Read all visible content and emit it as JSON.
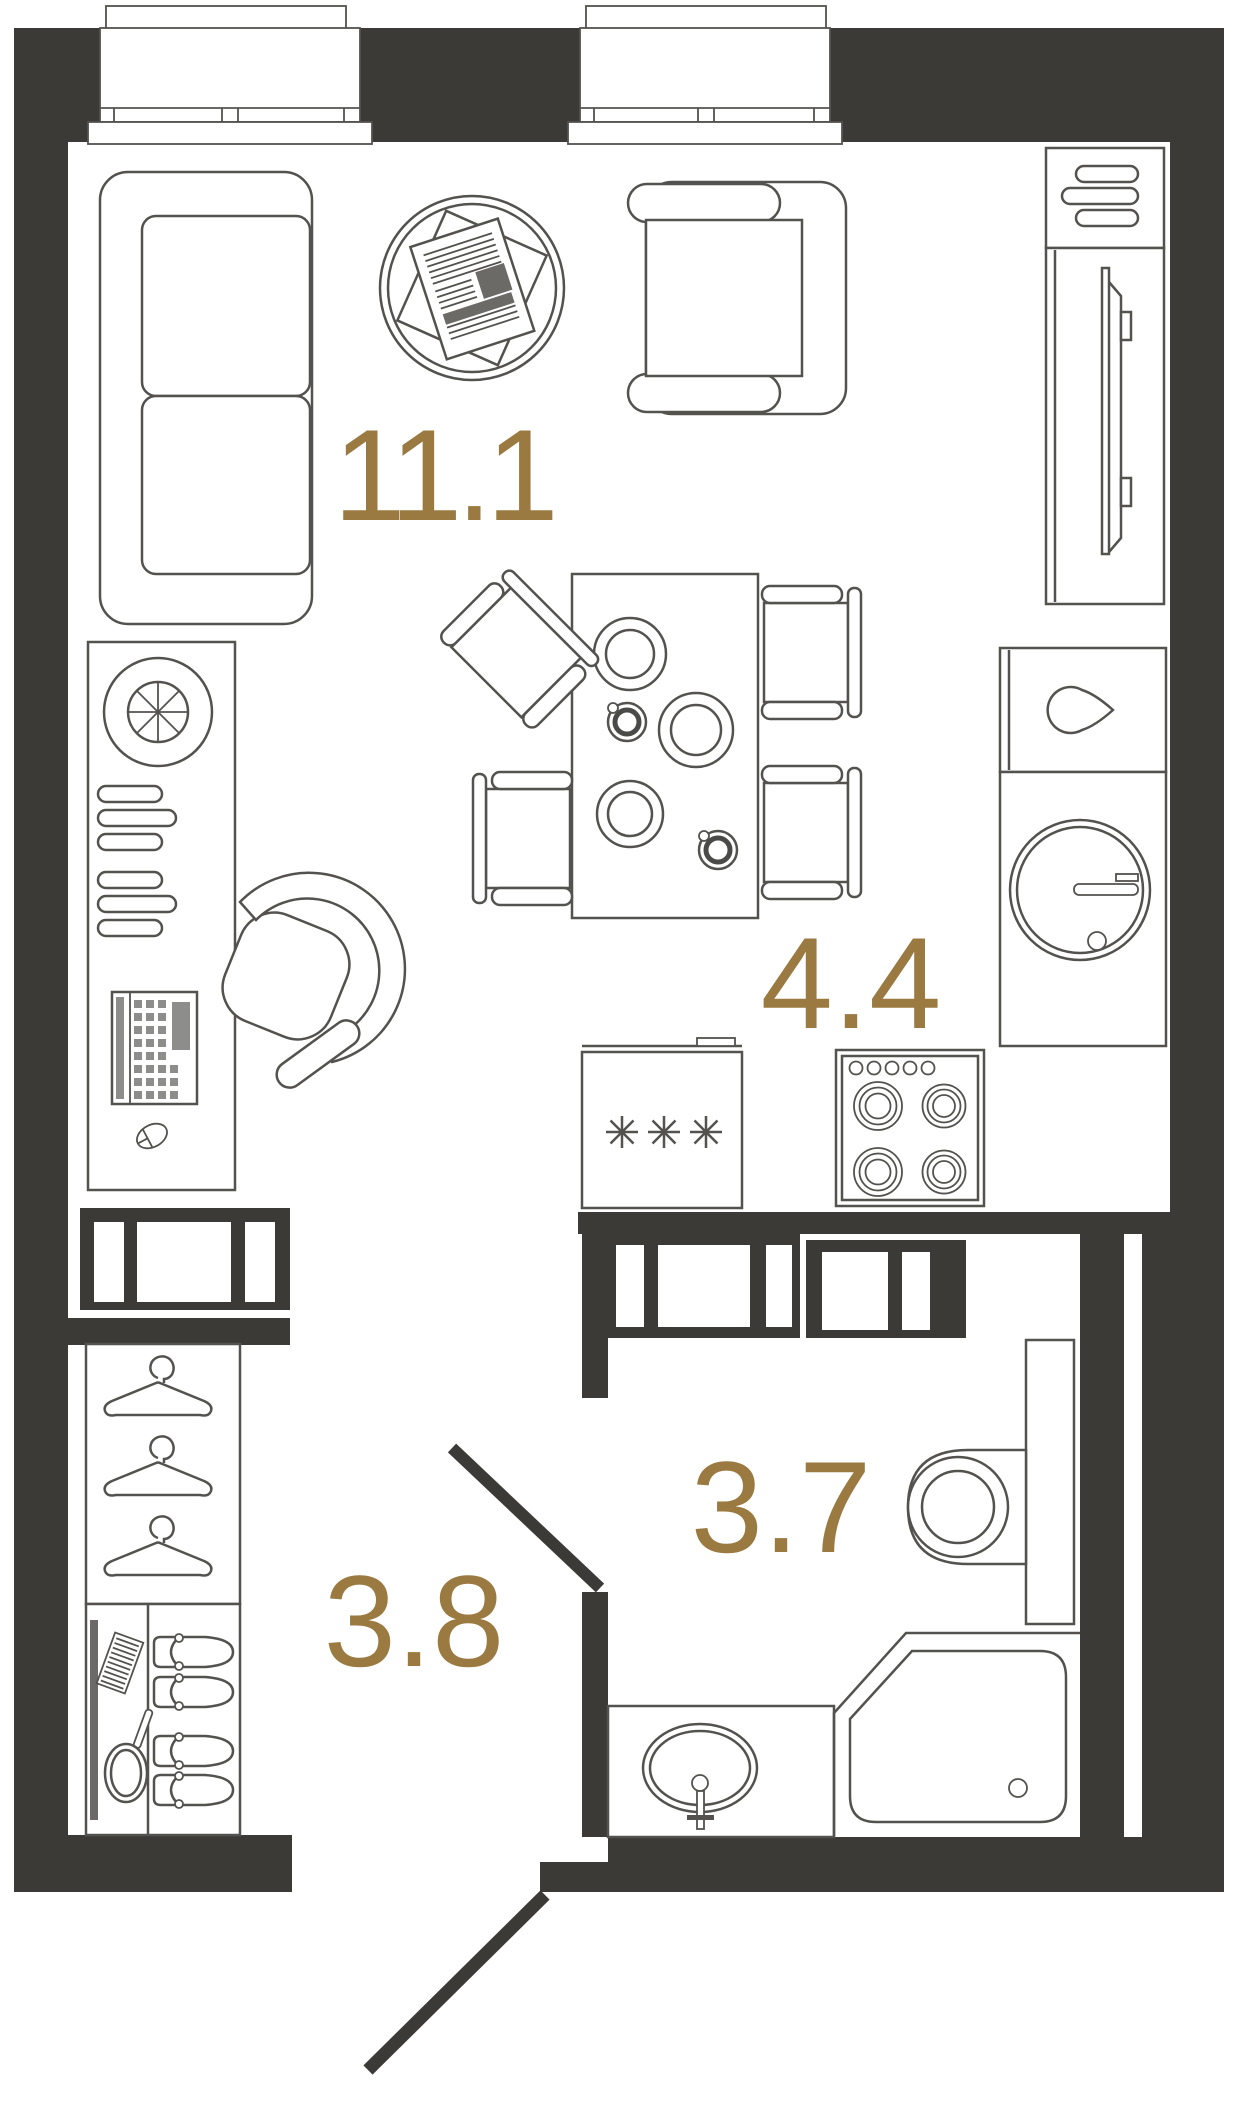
{
  "floorplan": {
    "rooms": [
      {
        "id": "living-room",
        "area_label": "11.1"
      },
      {
        "id": "kitchen",
        "area_label": "4.4"
      },
      {
        "id": "bathroom",
        "area_label": "3.7"
      },
      {
        "id": "hallway",
        "area_label": "3.8"
      }
    ],
    "colors": {
      "wall": "#3b3a37",
      "furniture_line": "#53524f",
      "area_label": "#9a7a41",
      "detail_fill": "#8d8d8b",
      "dark_detail": "#6b6a66"
    },
    "icons": [
      "window-icon",
      "sofa-icon",
      "coffee-table-icon",
      "newspaper-icon",
      "armchair-icon",
      "tv-stand-icon",
      "shelf-bars-icon",
      "dining-table-icon",
      "chair-icon",
      "plate-icon",
      "cup-icon",
      "kitchen-sink-icon",
      "kitchen-shelves-icon",
      "keyboard-icon",
      "mouse-icon",
      "desk-chair-icon",
      "freezer-icon",
      "snowflake-icon",
      "stove-icon",
      "water-drop-icon",
      "round-sink-icon",
      "faucet-icon",
      "door-leaf-icon",
      "hanger-icon",
      "comb-icon",
      "hand-mirror-icon",
      "slippers-icon",
      "toilet-icon",
      "washbasin-icon",
      "shower-icon"
    ]
  }
}
